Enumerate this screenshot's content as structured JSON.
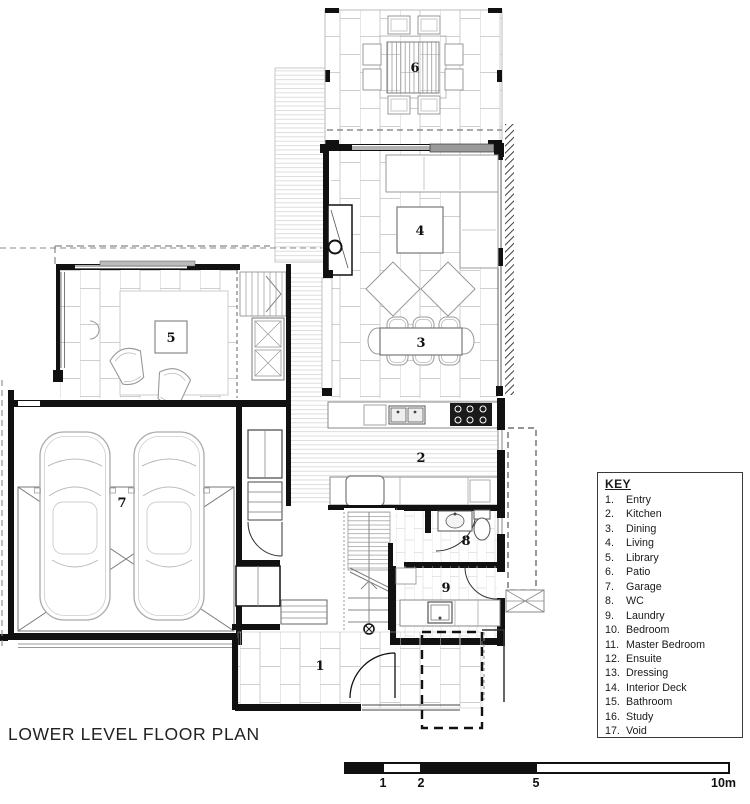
{
  "title": "LOWER LEVEL FLOOR PLAN",
  "key": {
    "header": "KEY",
    "items": [
      {
        "num": "1.",
        "label": "Entry"
      },
      {
        "num": "2.",
        "label": "Kitchen"
      },
      {
        "num": "3.",
        "label": "Dining"
      },
      {
        "num": "4.",
        "label": "Living"
      },
      {
        "num": "5.",
        "label": "Library"
      },
      {
        "num": "6.",
        "label": "Patio"
      },
      {
        "num": "7.",
        "label": "Garage"
      },
      {
        "num": "8.",
        "label": "WC"
      },
      {
        "num": "9.",
        "label": "Laundry"
      },
      {
        "num": "10.",
        "label": "Bedroom"
      },
      {
        "num": "11.",
        "label": "Master Bedroom"
      },
      {
        "num": "12.",
        "label": "Ensuite"
      },
      {
        "num": "13.",
        "label": "Dressing"
      },
      {
        "num": "14.",
        "label": "Interior Deck"
      },
      {
        "num": "15.",
        "label": "Bathroom"
      },
      {
        "num": "16.",
        "label": "Study"
      },
      {
        "num": "17.",
        "label": "Void"
      }
    ]
  },
  "room_labels": [
    {
      "num": "6",
      "name": "Patio"
    },
    {
      "num": "4",
      "name": "Living"
    },
    {
      "num": "3",
      "name": "Dining"
    },
    {
      "num": "2",
      "name": "Kitchen"
    },
    {
      "num": "5",
      "name": "Library"
    },
    {
      "num": "7",
      "name": "Garage"
    },
    {
      "num": "8",
      "name": "WC"
    },
    {
      "num": "9",
      "name": "Laundry"
    },
    {
      "num": "1",
      "name": "Entry"
    }
  ],
  "scalebar": {
    "tick_labels": [
      "1",
      "2",
      "5",
      "10m"
    ]
  },
  "colors": {
    "wall": "#111111",
    "pattern_light": "#cfcfcf",
    "furniture": "#999999",
    "background": "#ffffff"
  }
}
